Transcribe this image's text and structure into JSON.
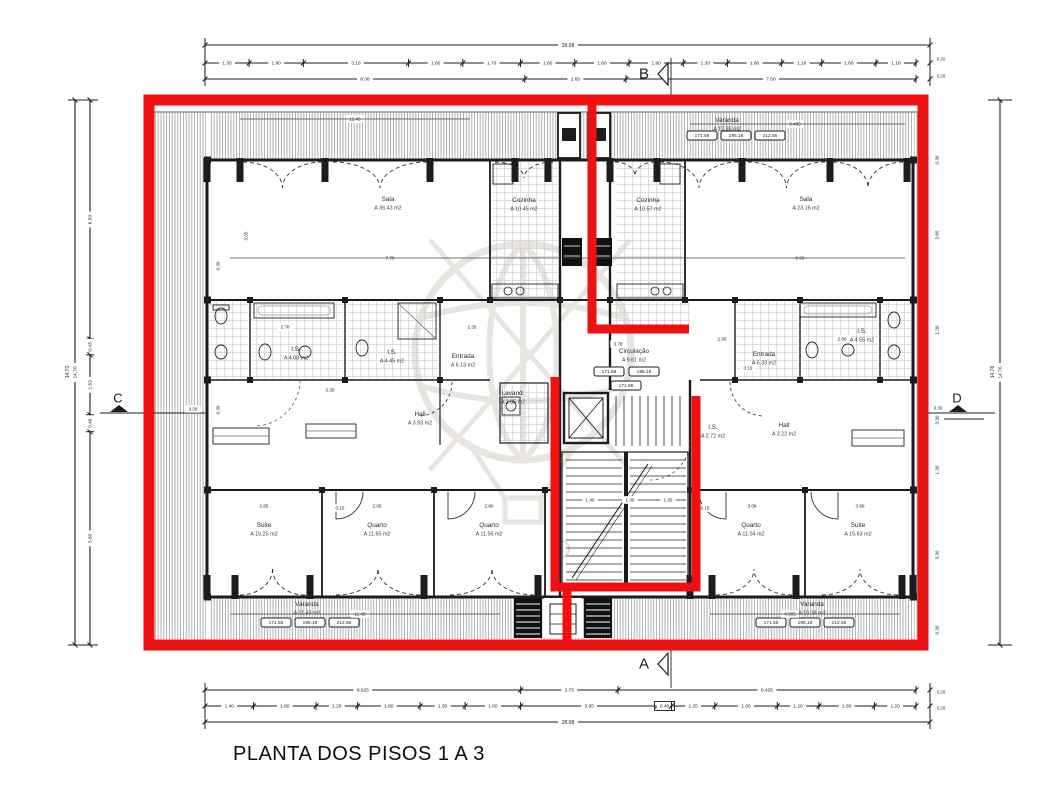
{
  "title": "PLANTA DOS PISOS 1 A 3",
  "colors": {
    "highlight_red": "#ee1111",
    "ink": "#1c1c1c",
    "tile_grid": "#cfcfcf",
    "hatch_gray": "#8f8f8f",
    "watermark_gray": "#e8e5e1"
  },
  "section_markers": {
    "top": "B",
    "bottom": "A",
    "left": "C",
    "right": "D"
  },
  "dim_top": {
    "overall": "28.08",
    "detail": [
      "1.30",
      "1.60",
      "3.10",
      "1.60",
      "1.70",
      "1.60",
      "1.60",
      "1.60",
      "1.30",
      "1.60",
      "1.18",
      "1.60",
      "1.18"
    ],
    "group": [
      "8.38",
      "2.65",
      "7.60"
    ],
    "edge": [
      "0.20",
      "0.20"
    ]
  },
  "dim_bottom": {
    "group": [
      "8.925",
      "2.75",
      "8.425"
    ],
    "detail": [
      "1.40",
      "1.80",
      "1.20",
      "1.80",
      "1.30",
      "1.60",
      "3.95",
      "0.40",
      "1.25",
      "1.80",
      "1.20",
      "1.60",
      "1.20"
    ],
    "overall": "28.08",
    "edge": [
      "0.20",
      "0.20"
    ]
  },
  "dim_left": {
    "overall": "14.70",
    "segments": [
      "6.50",
      "0.43",
      "1.63",
      "0.46",
      "5.80"
    ]
  },
  "dim_right": {
    "overall": "14.76",
    "wall_dims": [
      "0.30",
      "3.65",
      "1.30",
      "3.30",
      "1.30",
      "3.30",
      "0.30"
    ]
  },
  "marker_dims": {
    "left": "0.30",
    "right": "0.30"
  },
  "rooms": [
    {
      "name": "Sala",
      "area": "A 36.43 m2"
    },
    {
      "name": "Cozinha",
      "area": "A 10.45 m2"
    },
    {
      "name": "Cozinha",
      "area": "A 10.57 m2"
    },
    {
      "name": "Sala",
      "area": "A 23.16 m2"
    },
    {
      "name": "Varanda",
      "area": "A 12.86 m2"
    },
    {
      "name": "Entrada",
      "area": "A 6.13 m2"
    },
    {
      "name": "Entrada",
      "area": "A 6.33 m2"
    },
    {
      "name": "Circulação",
      "area": "A 9.61 m2"
    },
    {
      "name": "Lavand.",
      "area": "A 2.35 m2"
    },
    {
      "name": "Hall",
      "area": "A 3.93 m2"
    },
    {
      "name": "Hall",
      "area": "A 3.22 m2"
    },
    {
      "name": "I.S.",
      "area": "A 4.08 m2"
    },
    {
      "name": "I.S.",
      "area": "A 4.45 m2"
    },
    {
      "name": "I.S.",
      "area": "A 4.55 m2"
    },
    {
      "name": "I.S.",
      "area": "A 2.72 m2"
    },
    {
      "name": "Suite",
      "area": "A 15.25 m2"
    },
    {
      "name": "Quarto",
      "area": "A 11.65 m2"
    },
    {
      "name": "Quarto",
      "area": "A 11.56 m2"
    },
    {
      "name": "Quarto",
      "area": "A 11.04 m2"
    },
    {
      "name": "Suite",
      "area": "A 15.63 m2"
    },
    {
      "name": "Varanda",
      "area": "A 11.43 m2"
    },
    {
      "name": "Varanda",
      "area": "A 10.18 m2"
    }
  ],
  "level_tags": [
    "171.56",
    "196.18",
    "212.56"
  ],
  "interior_dims": [
    "11.45",
    "8.405",
    "7.78",
    "6.90",
    "3.05",
    "3.78",
    "2.78",
    "2.35",
    "2.95",
    "2.60",
    "3.19",
    "3.30",
    "2.85",
    "2.95",
    "2.80",
    "3.08",
    "3.80",
    "1.40",
    "1.30",
    "1.85",
    "0.15",
    "0.15",
    "4.305",
    "11.43",
    "0.30",
    "0.30"
  ],
  "watermark": {
    "registered": "®"
  }
}
